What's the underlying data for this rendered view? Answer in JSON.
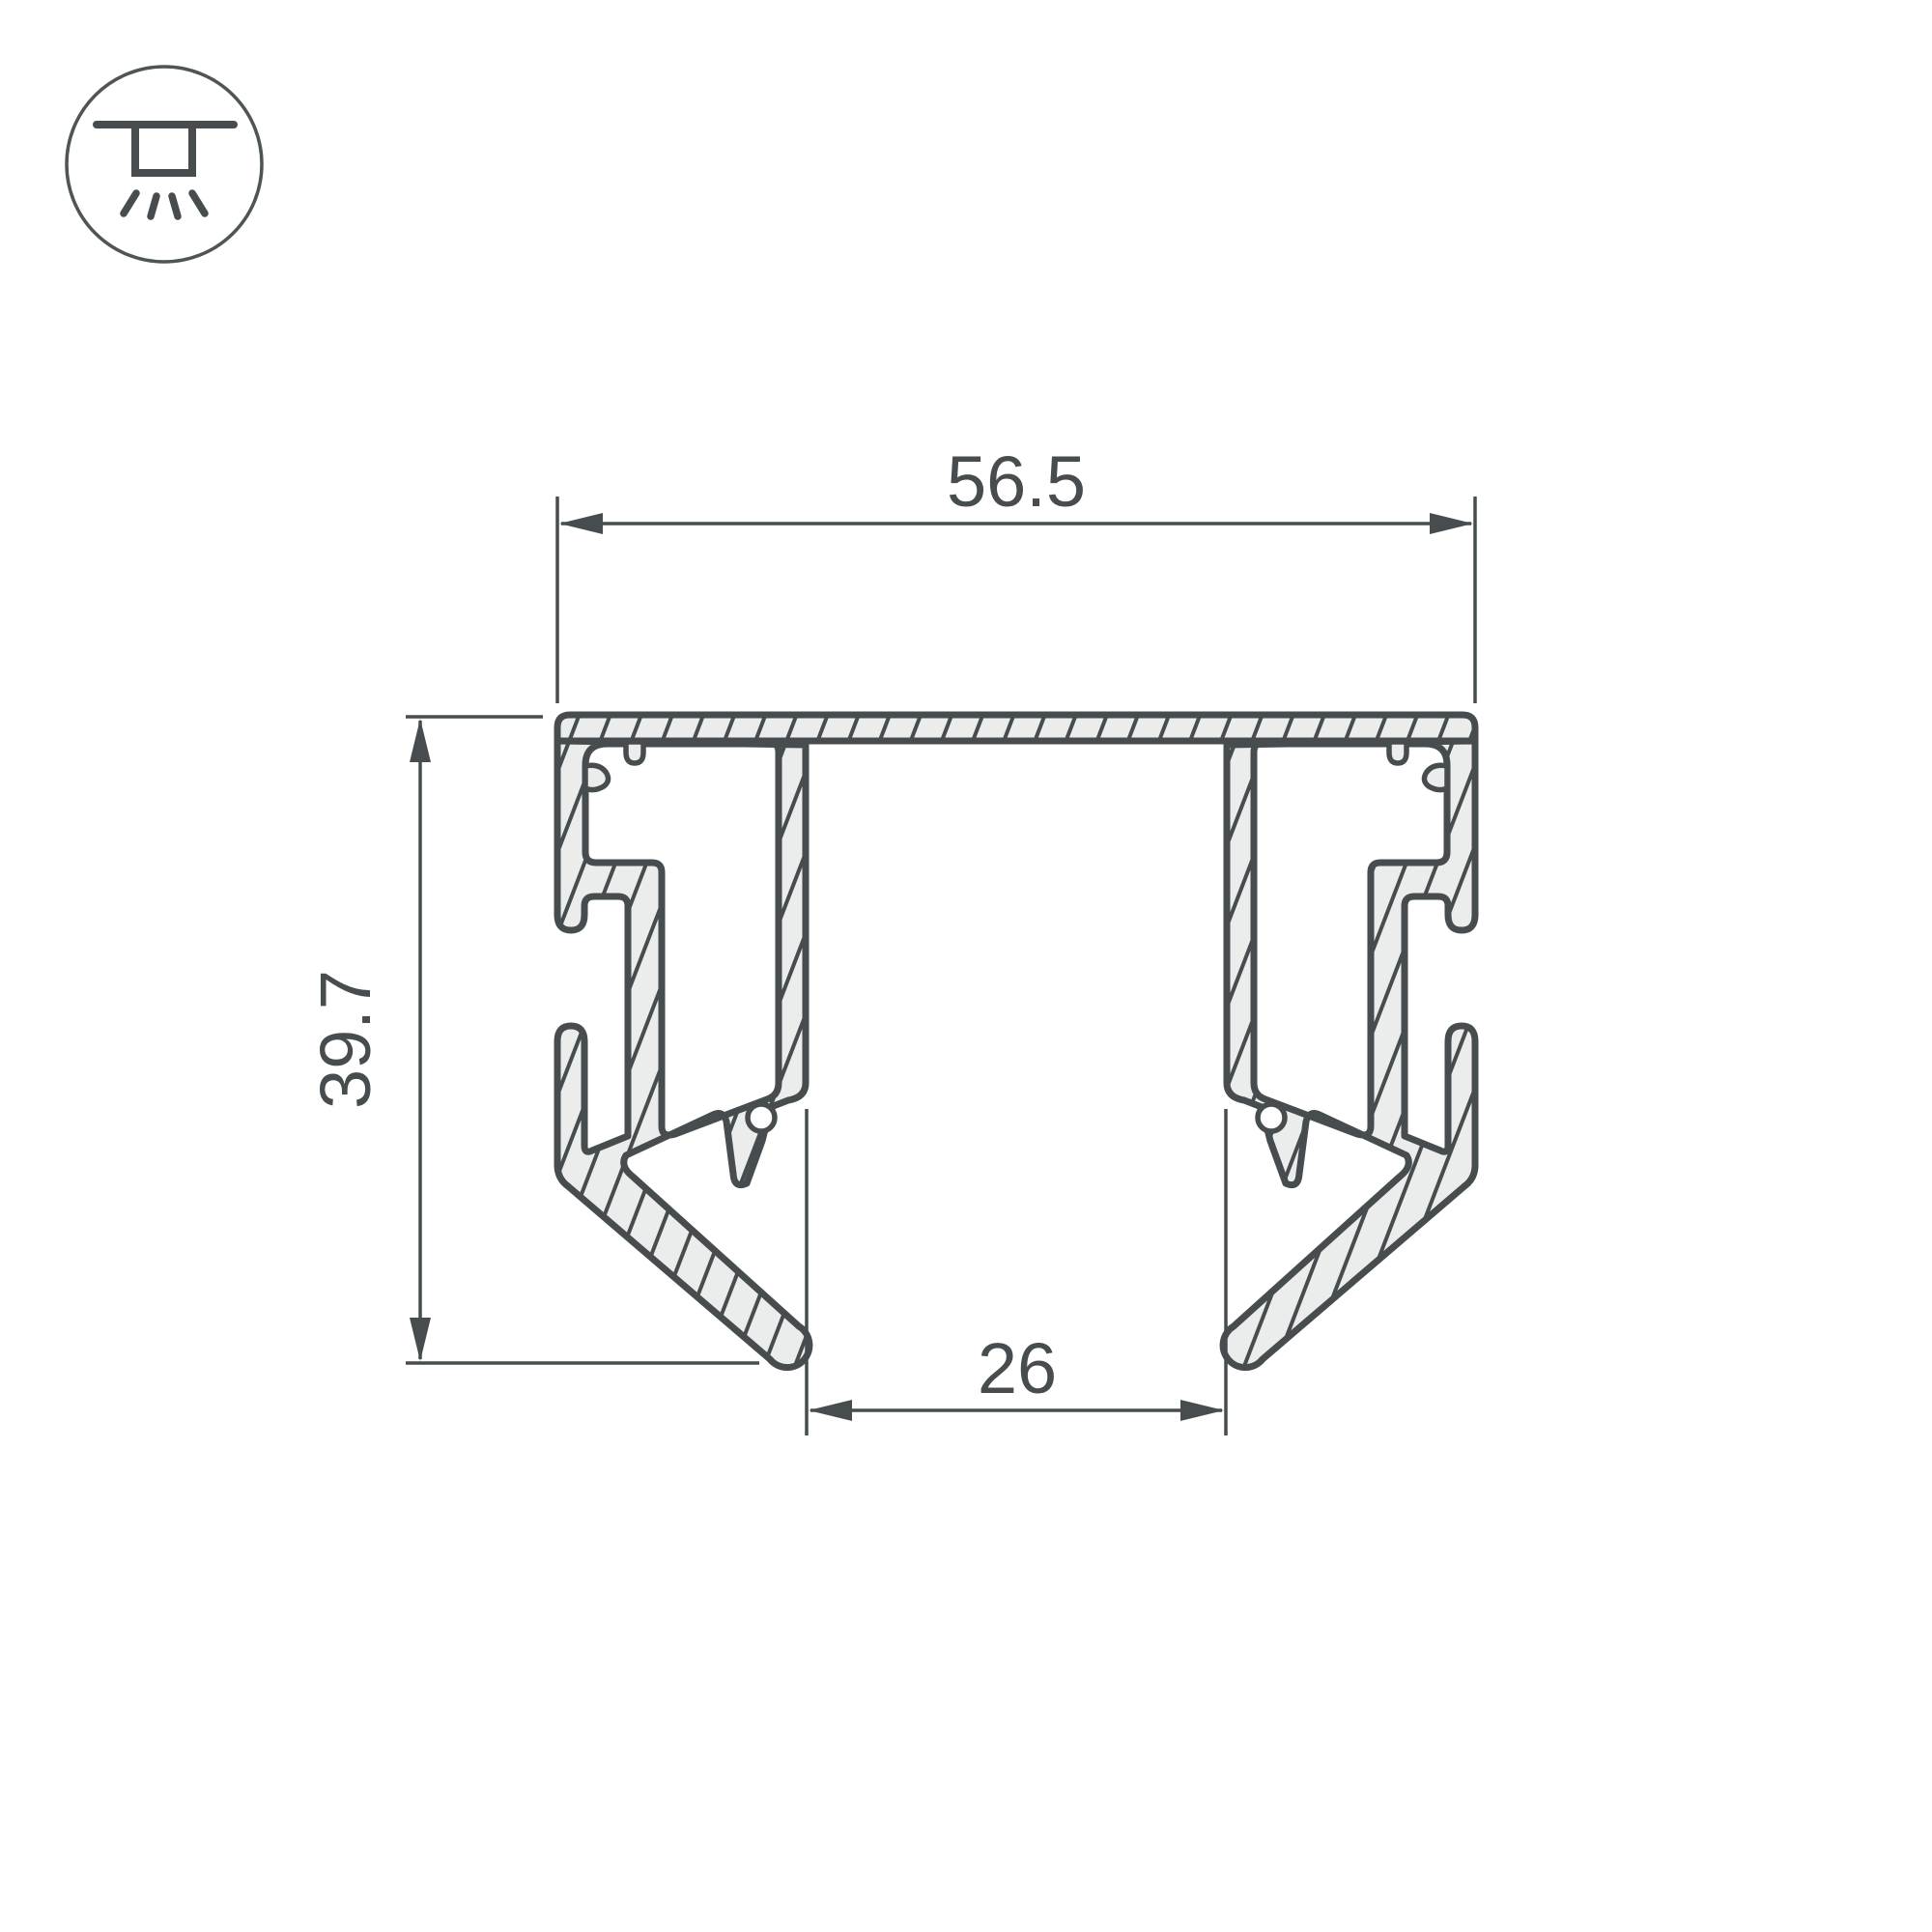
{
  "drawing": {
    "title": "LED profile cross-section technical drawing",
    "dimensions": {
      "width_top": "56.5",
      "height_left": "39.7",
      "bottom_inner_width": "26"
    },
    "colors": {
      "line": "#474d4f",
      "material_fill": "#ebecec",
      "background": "#ffffff"
    },
    "icon": {
      "name": "ceiling-surface-mount-light-icon"
    }
  }
}
